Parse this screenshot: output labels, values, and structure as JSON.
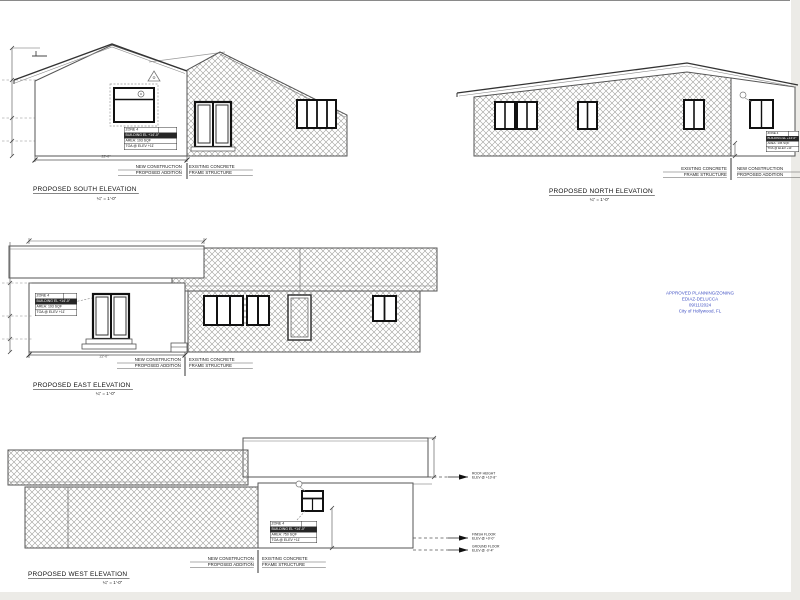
{
  "section_labels": {
    "new_construction_line1": "NEW CONSTRUCTION",
    "new_construction_line2": "PROPOSED ADDITION",
    "existing_line1": "EXISTING CONCRETE",
    "existing_line2": "FRAME STRUCTURE"
  },
  "elevations": {
    "south": {
      "title": "PROPOSED SOUTH ELEVATION",
      "scale": "¼\" = 1'-0\"",
      "dim_width": "22'-0\"",
      "zone_table": [
        "ZONE 4",
        "BUILDING EL +14'-0\"",
        "AREA: 193 SQF",
        "TOA @ ELEV +11'"
      ]
    },
    "north": {
      "title": "PROPOSED NORTH ELEVATION",
      "scale": "¼\" = 1'-0\"",
      "zone_table": [
        "ZONE 4",
        "BUILDING EL +14'-0\"",
        "AREA: 136 SQF",
        "TOA @ ELEV +11'"
      ]
    },
    "east": {
      "title": "PROPOSED EAST ELEVATION",
      "scale": "¼\" = 1'-0\"",
      "dim_width": "22'-0\"",
      "zone_table": [
        "ZONE 4",
        "BUILDING EL +14'-0\"",
        "AREA: 193 SQF",
        "TOA @ ELEV +11'"
      ]
    },
    "west": {
      "title": "PROPOSED WEST ELEVATION",
      "scale": "¼\" = 1'-0\"",
      "zone_table": [
        "ZONE 4",
        "BUILDING EL +14'-0\"",
        "AREA: 750 SQF",
        "TOA @ ELEV +11'"
      ]
    }
  },
  "level_markers": [
    {
      "line1": "ROOF HEIGHT",
      "line2": "ELEV @ +10'-8\""
    },
    {
      "line1": "FINISH FLOOR",
      "line2": "ELEV @ +0'-0\""
    },
    {
      "line1": "GROUND FLOOR",
      "line2": "ELEV @ -0'-4\""
    }
  ],
  "stamp": {
    "color": "#4353c4",
    "line1": "APPROVED PLANNING/ZONING",
    "line2": "EDIAZ-DELUCCA",
    "line3": "09/11/2024",
    "line4": "City of Hollywood, FL"
  }
}
